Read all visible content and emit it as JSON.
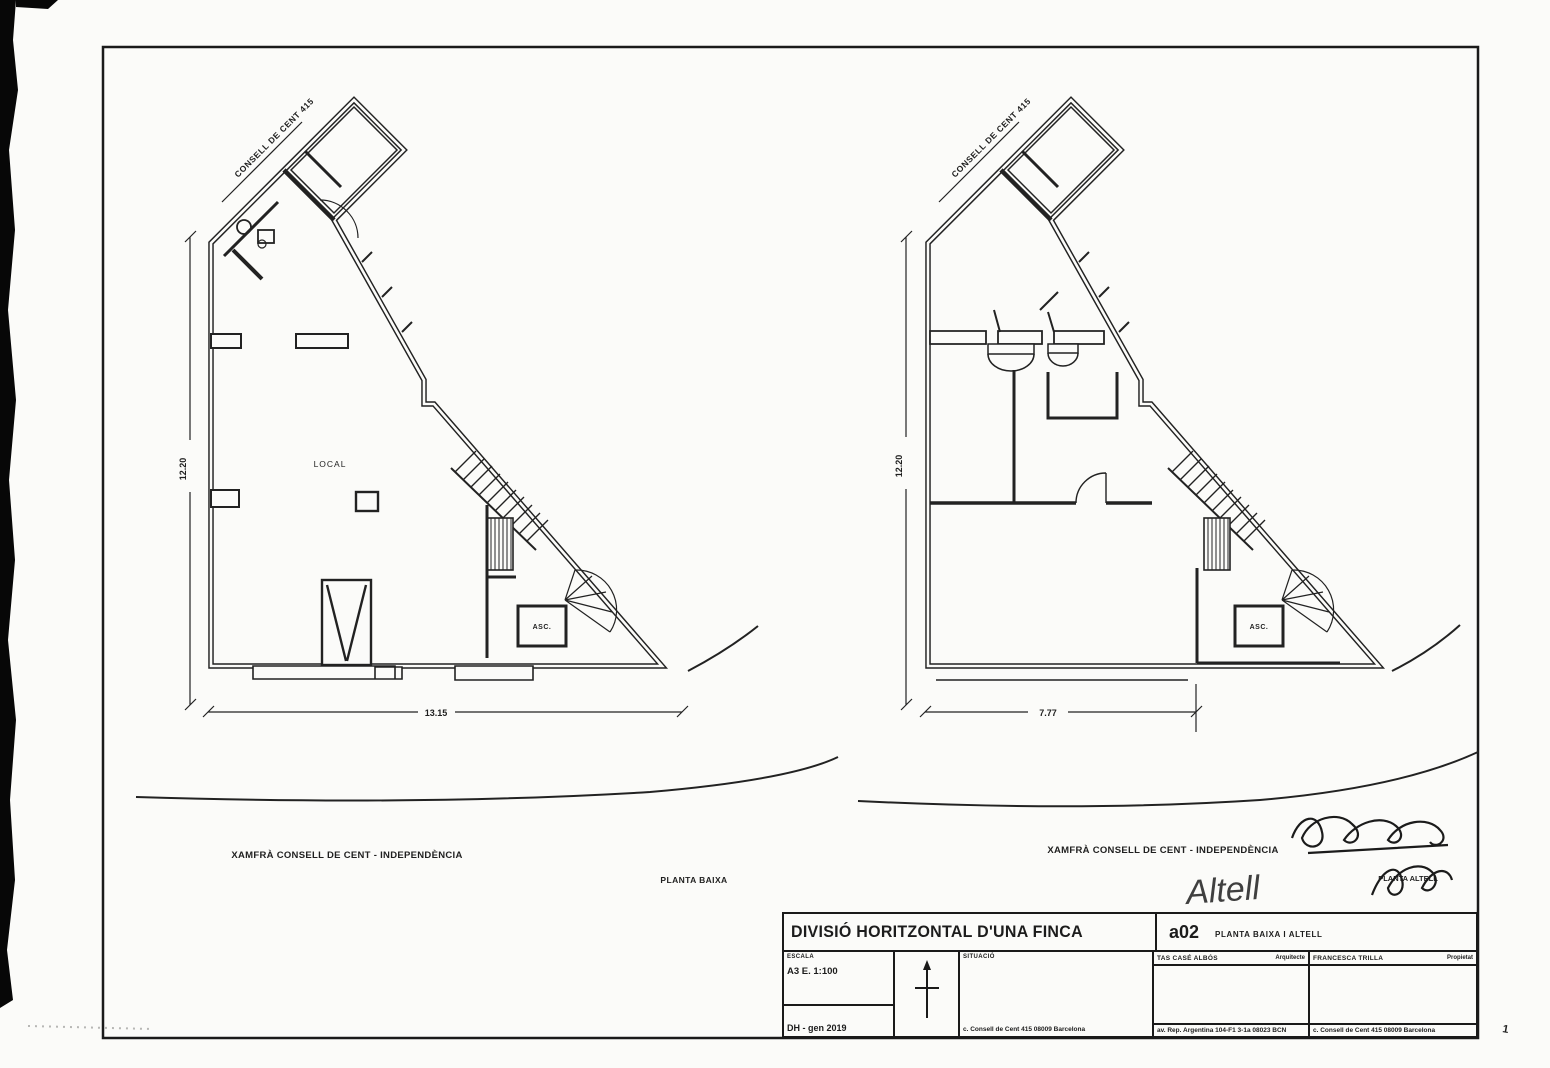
{
  "sheet": {
    "page_mark": "1"
  },
  "plan_left": {
    "street_label": "CONSELL DE CENT 415",
    "room_label": "LOCAL",
    "elevator_label": "ASC.",
    "dim_height": "12.20",
    "dim_width": "13.15",
    "caption": "XAMFRÀ CONSELL DE CENT - INDEPENDÈNCIA",
    "title": "PLANTA BAIXA"
  },
  "plan_right": {
    "street_label": "CONSELL DE CENT 415",
    "elevator_label": "ASC.",
    "dim_height": "12.20",
    "dim_width": "7.77",
    "caption": "XAMFRÀ CONSELL DE CENT - INDEPENDÈNCIA",
    "title": "PLANTA ALTELL",
    "handwritten_note": "Altell"
  },
  "title_block": {
    "project_title": "DIVISIÓ HORITZONTAL D'UNA FINCA",
    "sheet_code": "a02",
    "sheet_title": "PLANTA BAIXA I ALTELL",
    "scale_label": "ESCALA",
    "scale_value": "A3 E. 1:100",
    "date_value": "DH - gen 2019",
    "situation_label": "SITUACIÓ",
    "situation_address": "c. Consell de Cent 415 08009 Barcelona",
    "architect_name": "TAS CASÉ ALBÓS",
    "architect_role": "Arquitecte",
    "architect_address": "av. Rep. Argentina 104-F1 3-1a 08023 BCN",
    "owner_name": "FRANCESCA TRILLA",
    "owner_role": "Propietat",
    "owner_address": "c. Consell de Cent 415 08009 Barcelona"
  },
  "colors": {
    "ink": "#222222",
    "paper": "#fbfbf9"
  }
}
